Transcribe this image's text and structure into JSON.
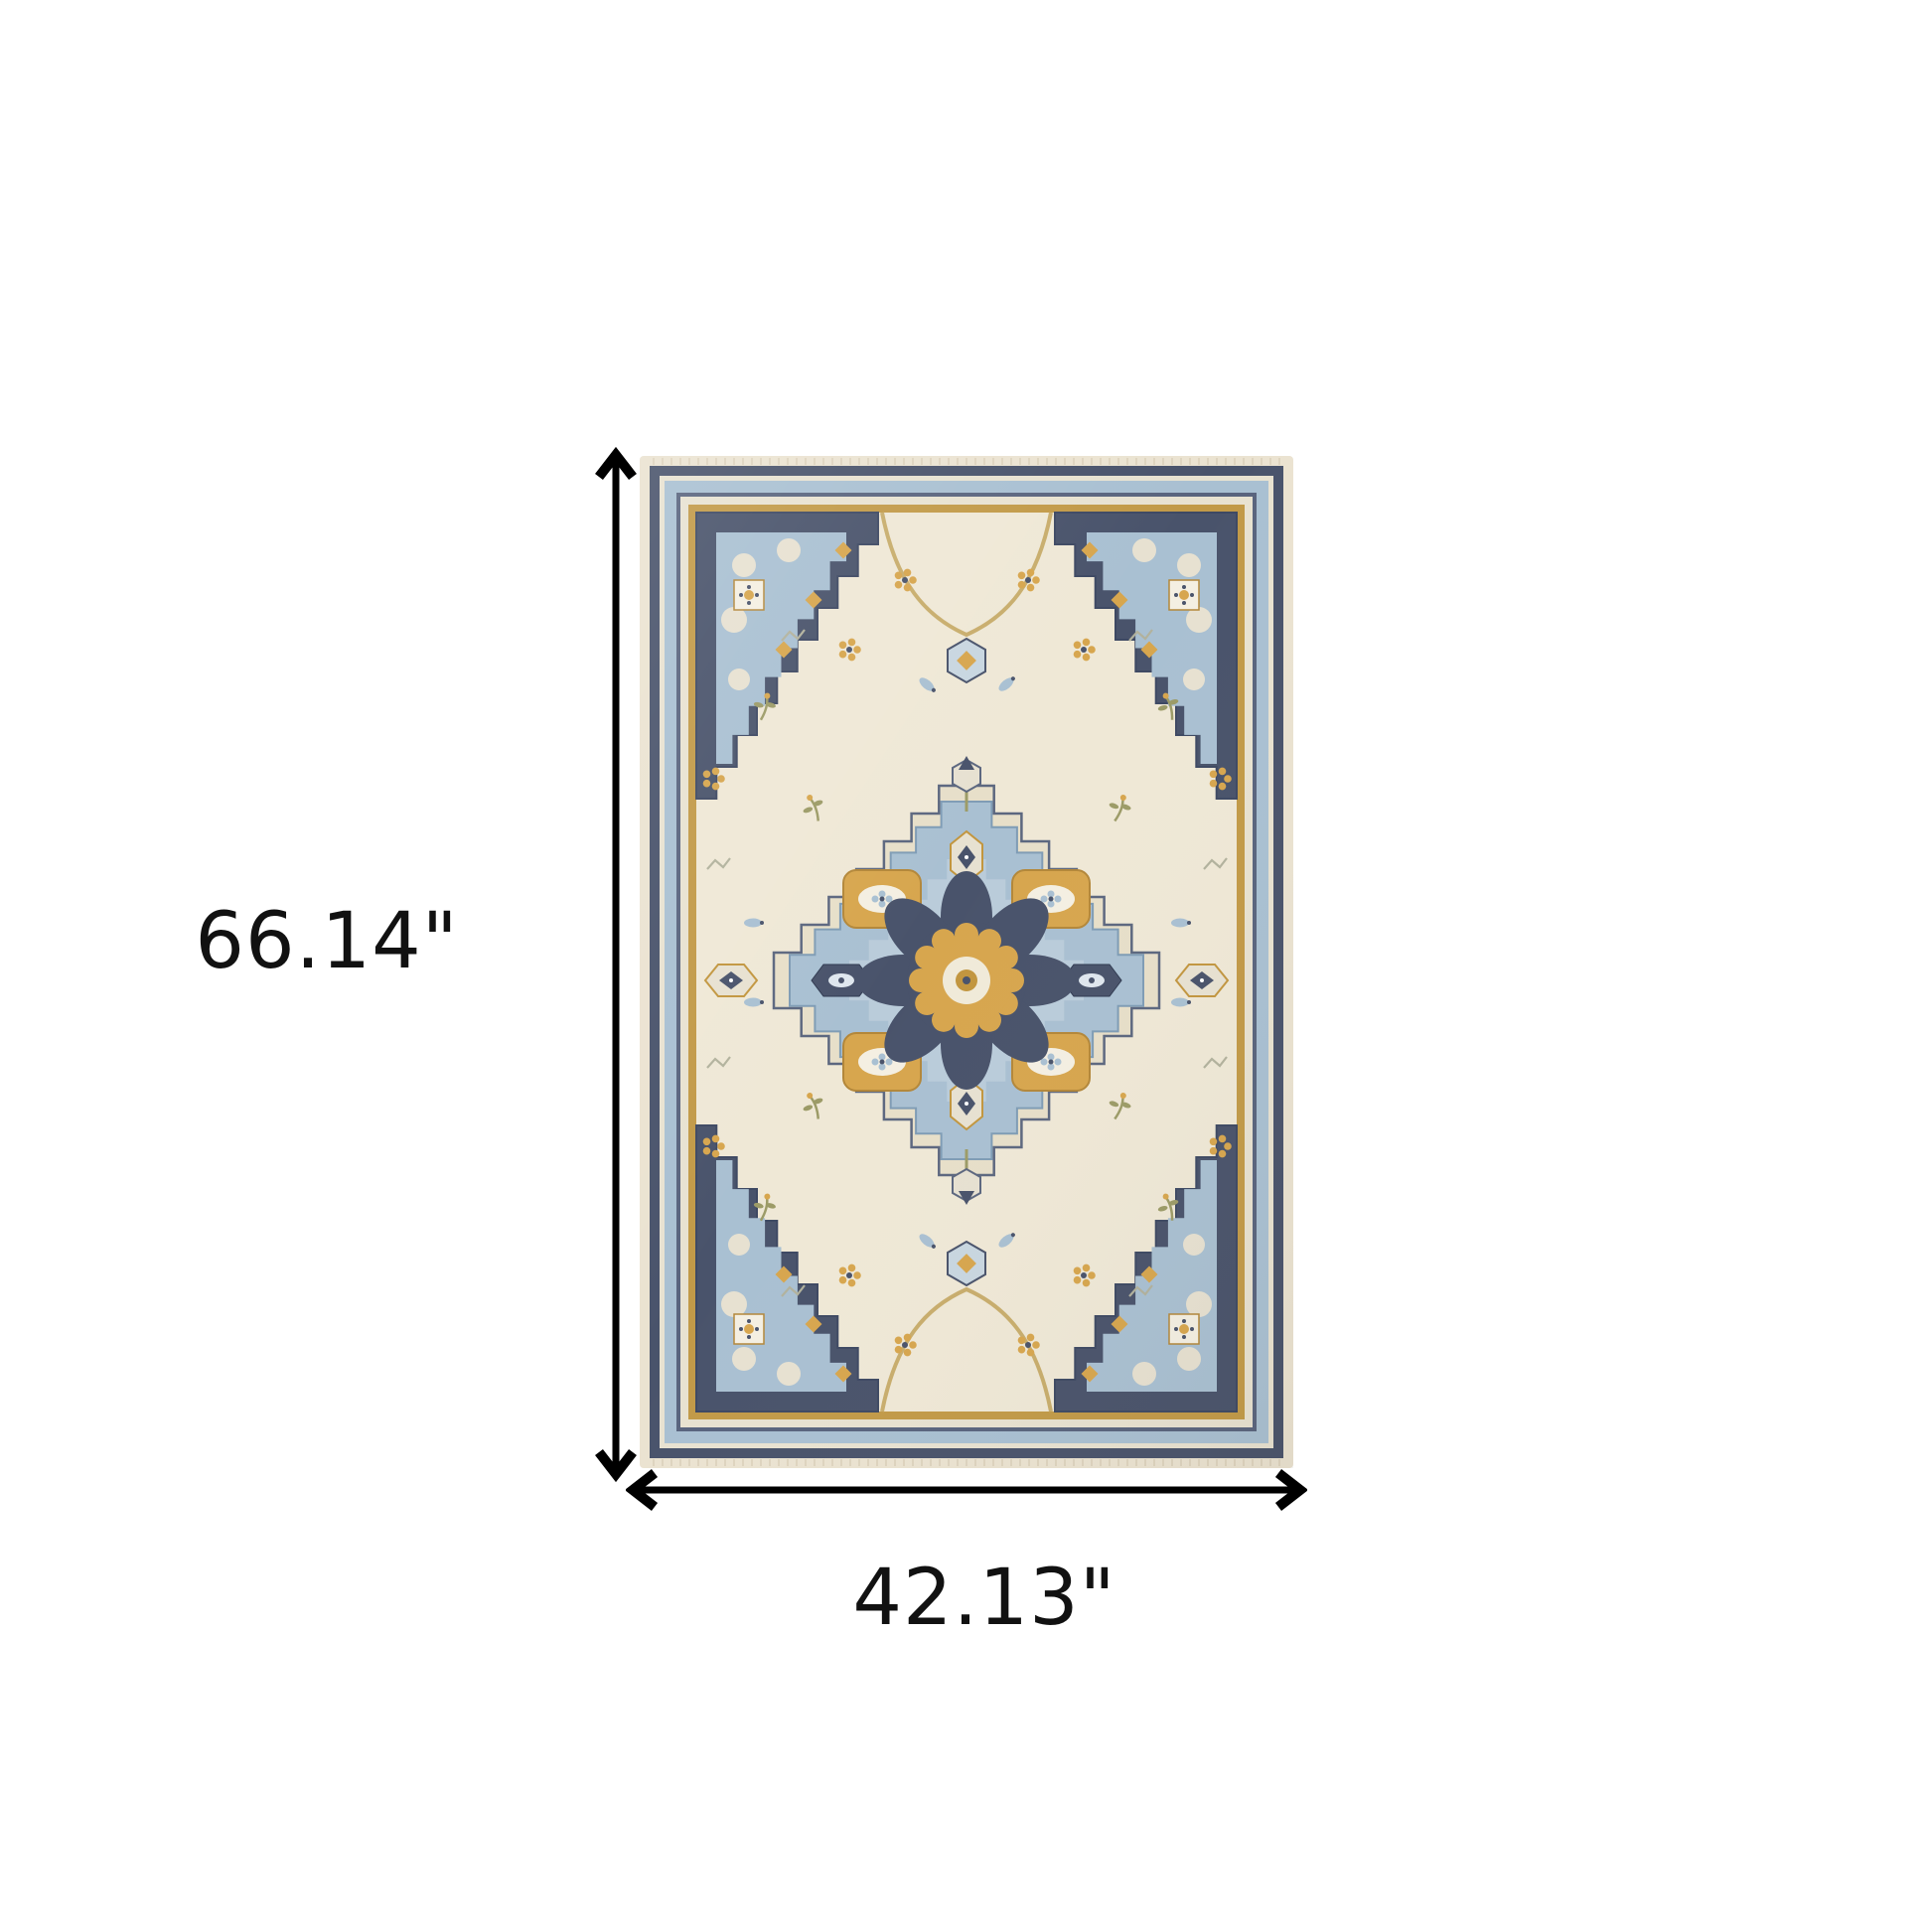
{
  "diagram": {
    "kind": "product-dimension-diagram",
    "product": "oriental medallion area rug",
    "background": "#ffffff"
  },
  "dimensions": {
    "height_label": "66.14\"",
    "width_label": "42.13\"",
    "arrow_color": "#000000",
    "label_color": "#111111"
  },
  "rug_colors": {
    "cream": "#ebe3d1",
    "ivory": "#efe8d6",
    "pale_line": "#e8e2d1",
    "navy": "#49536b",
    "navy_deep": "#3e4963",
    "navy_line": "#59647e",
    "light_blue": "#a9c0d2",
    "pale_blue": "#c8d6e0",
    "gold": "#d7a64e",
    "gold_deep": "#c2963f",
    "gold_border": "#c29a48",
    "olive": "#9c9b67",
    "sage": "#b2b29d",
    "halo": "#e7dfc9",
    "blob": "#e7e1d1",
    "white_motif": "#f4efe2"
  }
}
